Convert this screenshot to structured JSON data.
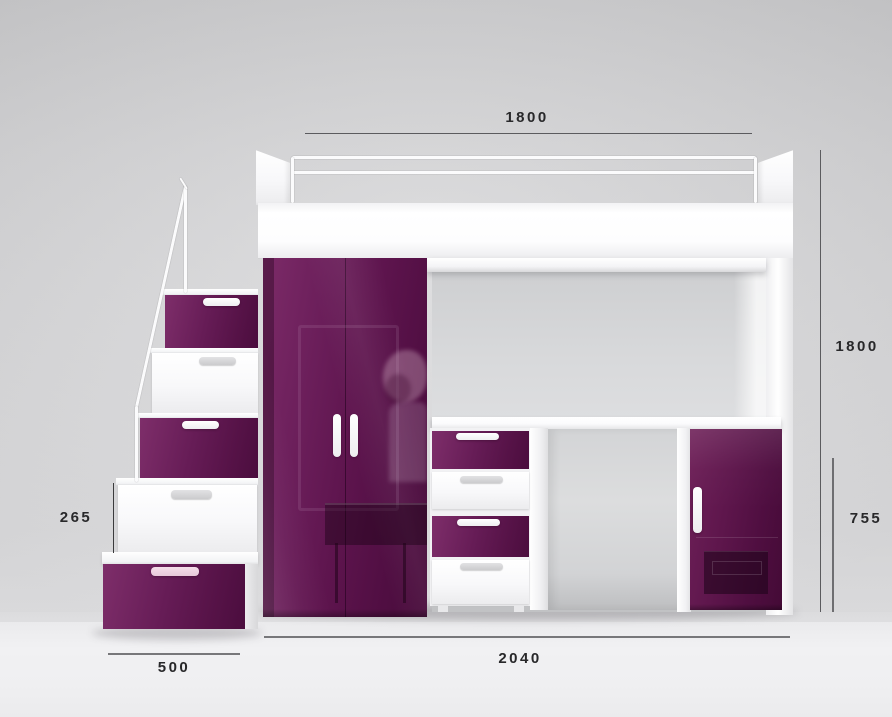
{
  "dimensions": {
    "bed_width": "1800",
    "total_height": "1800",
    "desk_clearance_height": "755",
    "step_height": "265",
    "steps_depth": "500",
    "total_width": "2040"
  },
  "colors": {
    "purple": "#5e1650",
    "purple_light": "#7e2e6a",
    "purple_dark": "#4b0d3e",
    "furniture_white": "#ffffff",
    "wall": "#d6d6d8",
    "floor": "#f0f0f2",
    "dimension_line": "#5b5b5e",
    "dimension_text": "#28282a"
  }
}
